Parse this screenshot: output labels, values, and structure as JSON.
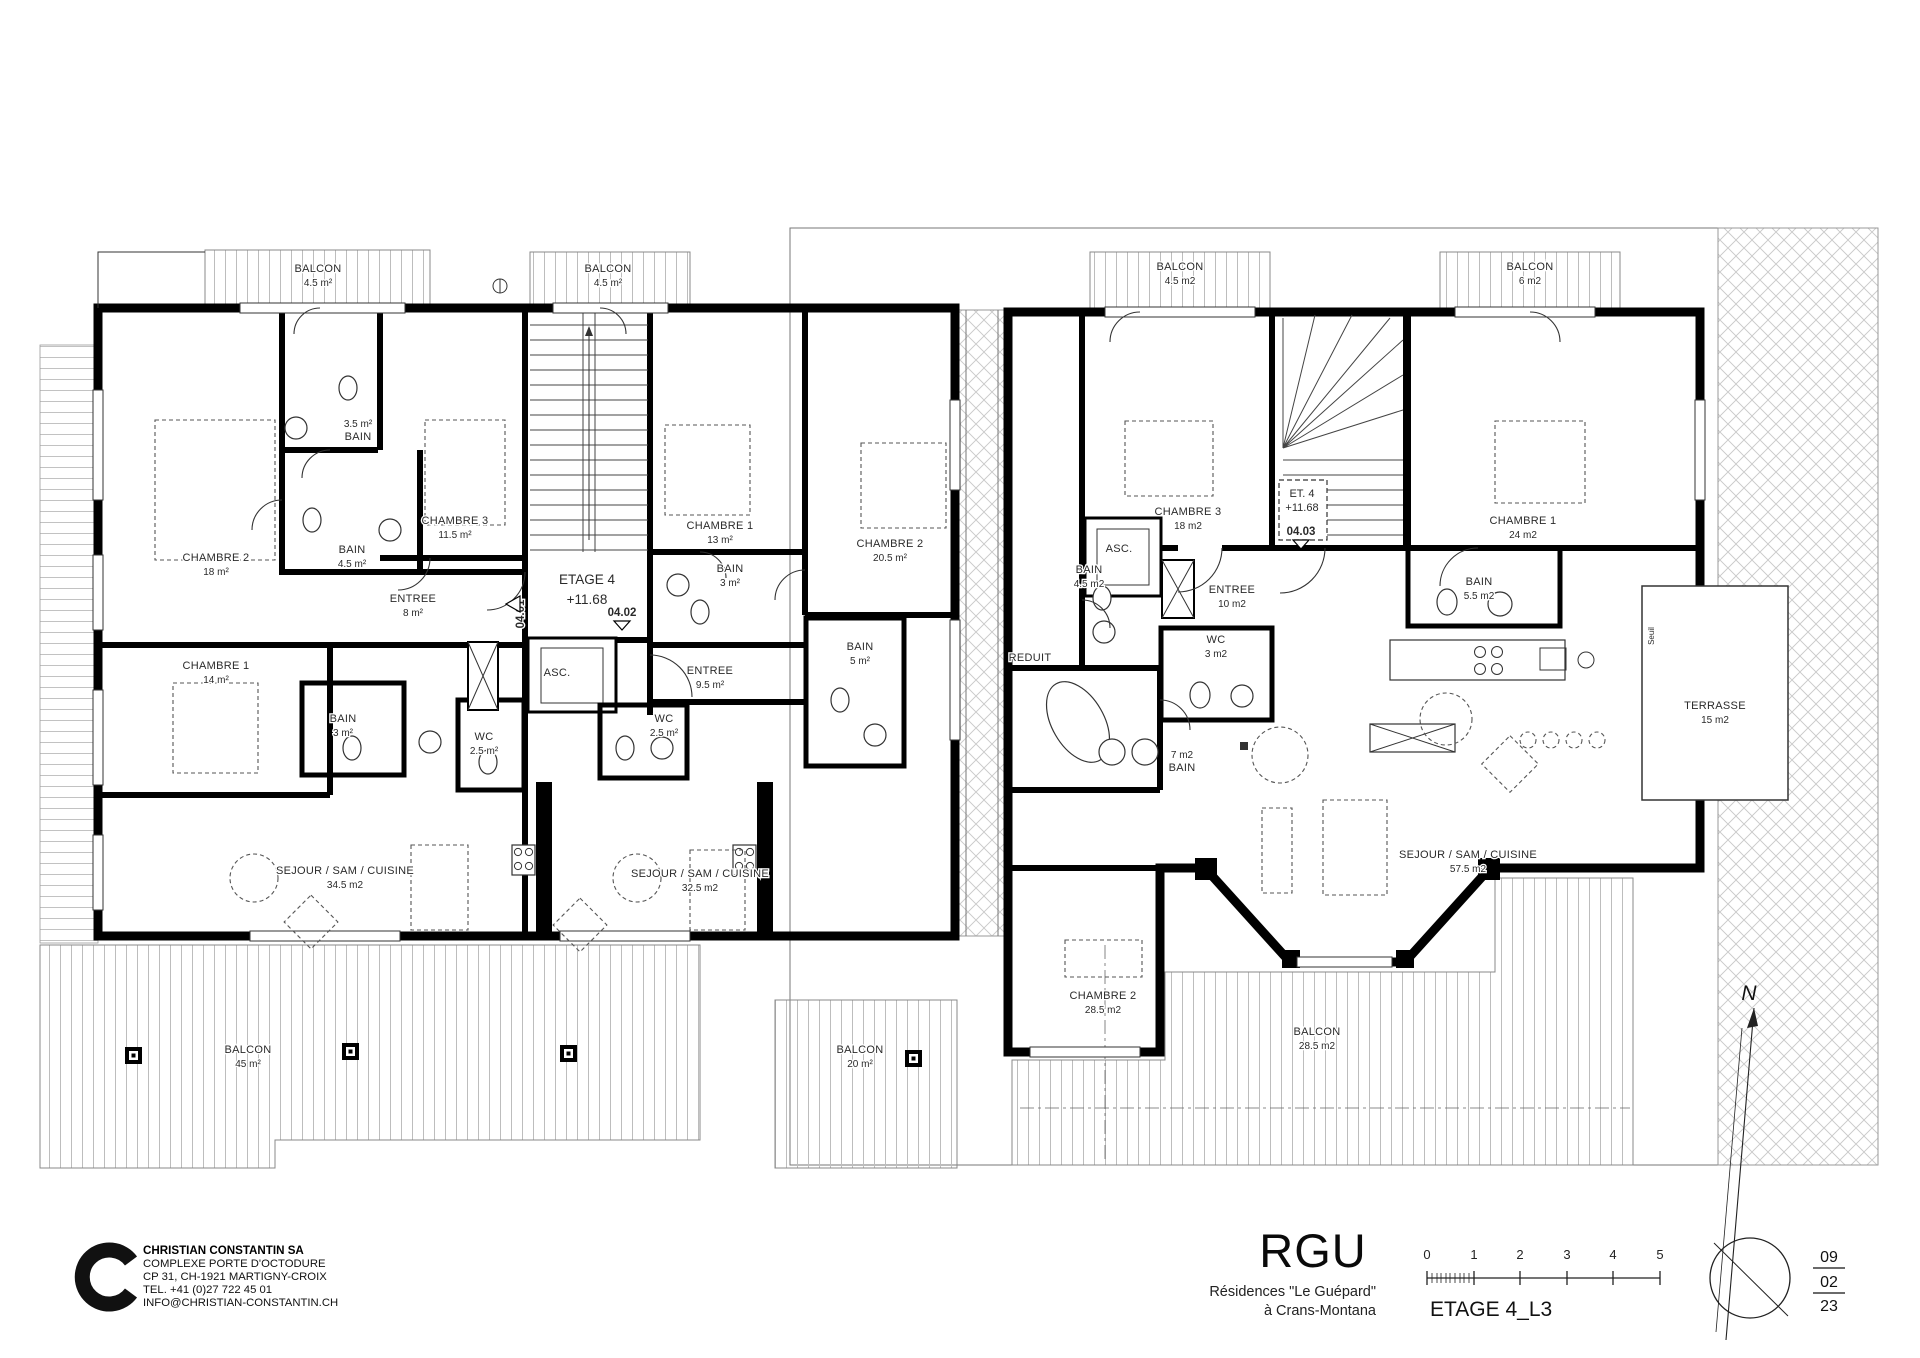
{
  "plan": {
    "rooms": [
      {
        "name": "BALCON",
        "area": "4.5 m²",
        "x": 318,
        "y": 272
      },
      {
        "name": "BALCON",
        "area": "4.5 m²",
        "x": 608,
        "y": 272
      },
      {
        "name": "BAIN",
        "area": "3.5 m²",
        "x": 358,
        "y": 427,
        "af": true
      },
      {
        "name": "CHAMBRE 3",
        "area": "11.5 m²",
        "x": 455,
        "y": 524
      },
      {
        "name": "CHAMBRE 2",
        "area": "18 m²",
        "x": 216,
        "y": 561
      },
      {
        "name": "BAIN",
        "area": "4.5 m²",
        "x": 352,
        "y": 553
      },
      {
        "name": "ENTREE",
        "area": "8 m²",
        "x": 413,
        "y": 602
      },
      {
        "name": "CHAMBRE 1",
        "area": "14 m²",
        "x": 216,
        "y": 669
      },
      {
        "name": "BAIN",
        "area": "3 m²",
        "x": 343,
        "y": 722
      },
      {
        "name": "WC",
        "area": "2.5 m²",
        "x": 484,
        "y": 740
      },
      {
        "name": "SEJOUR / SAM / CUISINE",
        "area": "34.5 m2",
        "x": 345,
        "y": 874
      },
      {
        "name": "BALCON",
        "area": "45 m²",
        "x": 248,
        "y": 1053
      },
      {
        "name": "ASC.",
        "x": 557,
        "y": 676
      },
      {
        "name": "CHAMBRE 1",
        "area": "13 m²",
        "x": 720,
        "y": 529
      },
      {
        "name": "BAIN",
        "area": "3 m²",
        "x": 730,
        "y": 572
      },
      {
        "name": "CHAMBRE 2",
        "area": "20.5 m²",
        "x": 890,
        "y": 547
      },
      {
        "name": "ENTREE",
        "area": "9.5 m²",
        "x": 710,
        "y": 674
      },
      {
        "name": "WC",
        "area": "2.5 m²",
        "x": 664,
        "y": 722
      },
      {
        "name": "BAIN",
        "area": "5 m²",
        "x": 860,
        "y": 650
      },
      {
        "name": "SEJOUR / SAM / CUISINE",
        "area": "32.5 m2",
        "x": 700,
        "y": 877
      },
      {
        "name": "BALCON",
        "area": "20 m²",
        "x": 860,
        "y": 1053
      },
      {
        "name": "BALCON",
        "area": "4.5 m2",
        "x": 1180,
        "y": 270
      },
      {
        "name": "BALCON",
        "area": "6 m2",
        "x": 1530,
        "y": 270
      },
      {
        "name": "CHAMBRE 3",
        "area": "18 m2",
        "x": 1188,
        "y": 515
      },
      {
        "name": "BAIN",
        "area": "4.5 m2",
        "x": 1089,
        "y": 573
      },
      {
        "name": "ENTREE",
        "area": "10 m2",
        "x": 1232,
        "y": 593
      },
      {
        "name": "WC",
        "area": "3 m2",
        "x": 1216,
        "y": 643
      },
      {
        "name": "REDUIT",
        "x": 1030,
        "y": 661
      },
      {
        "name": "ASC.",
        "x": 1119,
        "y": 552
      },
      {
        "name": "CHAMBRE 1",
        "area": "24 m2",
        "x": 1523,
        "y": 524
      },
      {
        "name": "BAIN",
        "area": "5.5 m2",
        "x": 1479,
        "y": 585
      },
      {
        "name": "BAIN",
        "area": "7 m2",
        "x": 1182,
        "y": 758,
        "af": true
      },
      {
        "name": "TERRASSE",
        "area": "15 m2",
        "x": 1715,
        "y": 709
      },
      {
        "name": "SEJOUR / SAM / CUISINE",
        "area": "57.5 m2",
        "x": 1468,
        "y": 858
      },
      {
        "name": "CHAMBRE 2",
        "area": "28.5 m2",
        "x": 1103,
        "y": 999
      },
      {
        "name": "BALCON",
        "area": "28.5 m2",
        "x": 1317,
        "y": 1035
      }
    ],
    "level_tags": [
      {
        "line1": "ETAGE 4",
        "line2": "+11.68"
      },
      {
        "line1": "ET. 4",
        "line2": "+11.68"
      }
    ],
    "door_tags": [
      "04.01",
      "04.02",
      "04.03"
    ],
    "seuil": "Seuil"
  },
  "title_block": {
    "company": {
      "name": "CHRISTIAN CONSTANTIN SA",
      "line2": "COMPLEXE PORTE D'OCTODURE",
      "line3": "CP 31, CH-1921 MARTIGNY-CROIX",
      "line4": "TEL. +41 (0)27 722 45 01",
      "line5": "INFO@CHRISTIAN-CONSTANTIN.CH"
    },
    "project": {
      "logo": "RGU",
      "line1": "Résidences \"Le Guépard\"",
      "line2": "à Crans-Montana"
    },
    "drawing_title": "ETAGE 4_L3",
    "scale_ticks": [
      "0",
      "1",
      "2",
      "3",
      "4",
      "5"
    ],
    "north_label": "N",
    "date": {
      "day": "09",
      "month": "02",
      "year": "23"
    }
  }
}
